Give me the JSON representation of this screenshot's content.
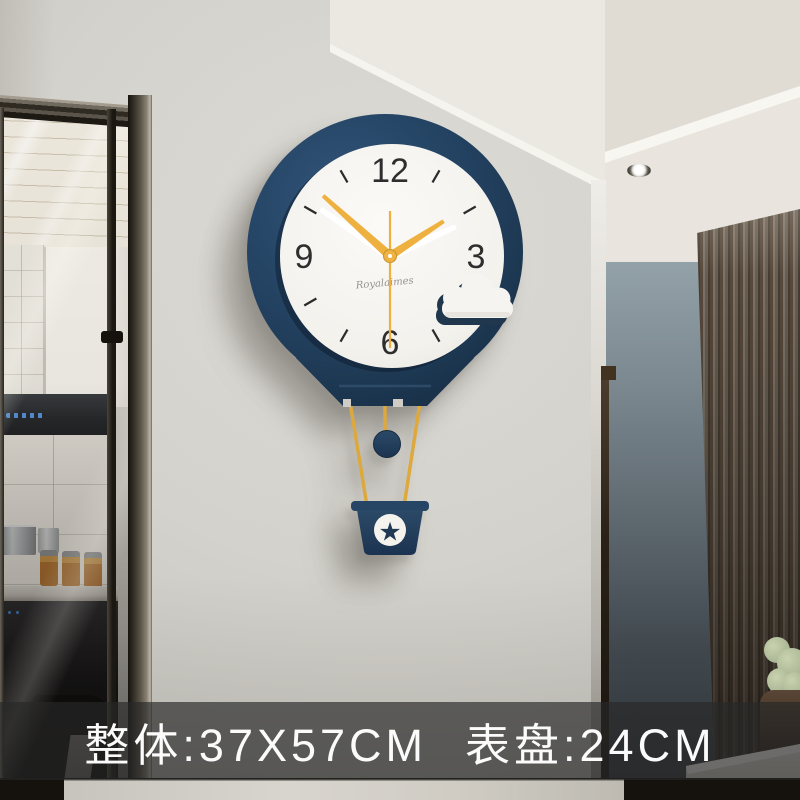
{
  "banner": {
    "overall_size": "整体:37X57CM",
    "dial_size": "表盘:24CM"
  },
  "clock": {
    "dial_numerals": {
      "twelve": "12",
      "three": "3",
      "six": "6",
      "nine": "9"
    },
    "brand_signature": "Royalaimes",
    "basket_star_icon": "★",
    "time_displayed": "01:52:30",
    "hands": {
      "hour_angle_deg": 57,
      "minute_angle_deg": 312,
      "second_angle_deg": 180,
      "shadow_hour_angle_deg": 66,
      "shadow_minute_angle_deg": 304
    },
    "colors": {
      "balloon_navy": "#213a55",
      "dial_white": "#f7f5f1",
      "hands_yellow": "#eeb13f",
      "rope_yellow": "#dda83c",
      "numeral_dark": "#2e2e2e"
    }
  },
  "scene": {
    "wall_color": "#d3d1cb",
    "accent_wall_color": "#8c9aa1",
    "slat_panel_color": "#6a6055",
    "banner_overlay_color": "rgba(40,40,40,0.67)",
    "banner_text_color": "#fbfbfb"
  }
}
